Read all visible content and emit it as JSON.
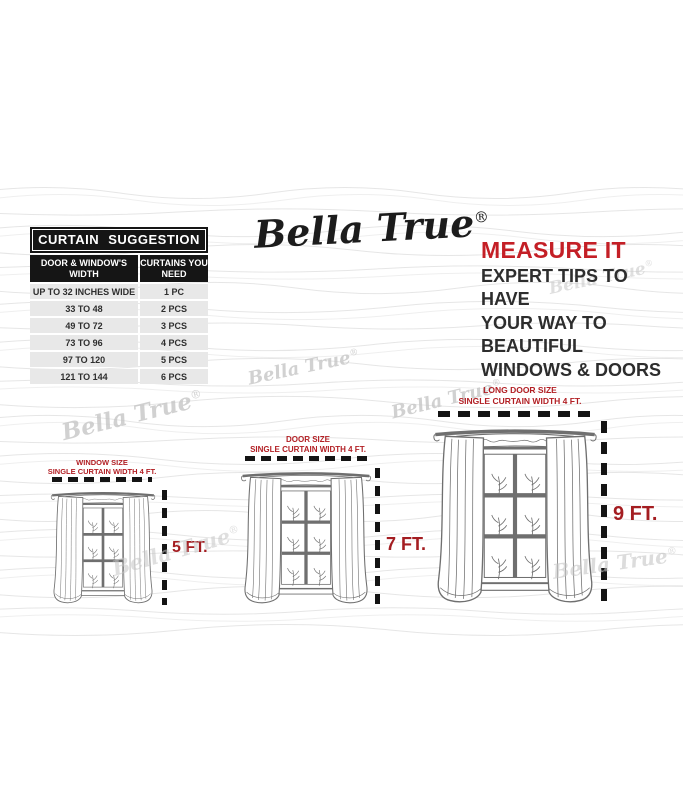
{
  "brand": {
    "name": "Bella True",
    "mark": "®"
  },
  "suggestion_table": {
    "title": "CURTAIN SUGGESTION",
    "col1_header": "DOOR & WINDOW'S WIDTH",
    "col2_header": "CURTAINS YOU NEED",
    "rows": [
      {
        "width": "UP TO 32 INCHES WIDE",
        "qty": "1 PC"
      },
      {
        "width": "33 TO 48",
        "qty": "2 PCS"
      },
      {
        "width": "49 TO 72",
        "qty": "3 PCS"
      },
      {
        "width": "73 TO 96",
        "qty": "4 PCS"
      },
      {
        "width": "97 TO 120",
        "qty": "5 PCS"
      },
      {
        "width": "121 TO 144",
        "qty": "6 PCS"
      }
    ]
  },
  "measure_tip": {
    "heading": "MEASURE IT",
    "lines": [
      "EXPERT TIPS TO HAVE",
      "YOUR WAY TO BEAUTIFUL",
      "WINDOWS & DOORS"
    ]
  },
  "sizes": [
    {
      "name": "WINDOW SIZE",
      "subtitle": "SINGLE CURTAIN WIDTH 4 FT.",
      "height": "5 FT."
    },
    {
      "name": "DOOR SIZE",
      "subtitle": "SINGLE CURTAIN WIDTH 4 FT.",
      "height": "7 FT."
    },
    {
      "name": "LONG DOOR SIZE",
      "subtitle": "SINGLE CURTAIN WIDTH 4 FT.",
      "height": "9 FT."
    }
  ],
  "watermark": {
    "text": "Bella True",
    "mark": "®"
  },
  "colors": {
    "accent_red": "#c41f26",
    "label_red": "#b21f24",
    "ft_red": "#a41d21",
    "table_black": "#151515",
    "row_gray": "#e8e8e8",
    "watermark_gray": "#c6c6c6",
    "sketch_stroke": "#6f6f6f",
    "wave_gray": "#e6e6e6"
  }
}
